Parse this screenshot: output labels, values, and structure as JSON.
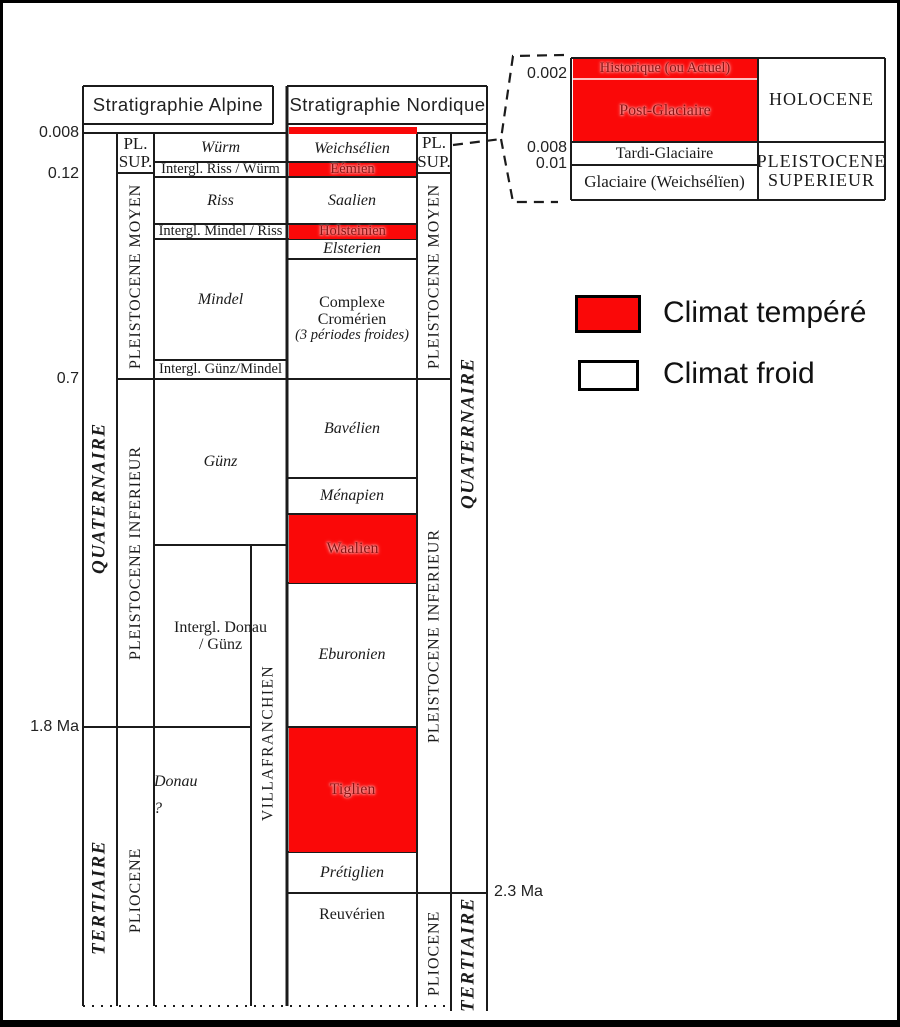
{
  "colors": {
    "red": "#fa0808",
    "red_text": "#8c1212",
    "line": "#1b1b1b"
  },
  "headers": {
    "alpine": "Stratigraphie  Alpine",
    "nordic": "Stratigraphie  Nordique"
  },
  "axis": {
    "a008": "0.008",
    "a012": "0.12",
    "a07": "0.7",
    "a18": "1.8 Ma",
    "a23": "2.3 Ma"
  },
  "left": {
    "quaternaire": "QUATERNAIRE",
    "tertiaire": "TERTIAIRE",
    "pl": "PL.",
    "sup": "SUP.",
    "moyen": "PLEISTOCENE MOYEN",
    "inferieur": "PLEISTOCENE INFERIEUR",
    "pliocene": "PLIOCENE"
  },
  "right": {
    "quaternaire": "QUATERNAIRE",
    "tertiaire": "TERTIAIRE",
    "pl": "PL.",
    "sup": "SUP.",
    "moyen": "PLEISTOCENE MOYEN",
    "inferieur": "PLEISTOCENE INFERIEUR",
    "pliocene": "PLIOCENE"
  },
  "alpine": {
    "wurm": "Würm",
    "riss_wurm": "Intergl. Riss / Würm",
    "riss": "Riss",
    "mindel_riss": "Intergl. Mindel / Riss",
    "mindel": "Mindel",
    "gunz_mindel": "Intergl. Günz/Mindel",
    "gunz": "Günz",
    "donau_gunz_l1": "Intergl. Donau",
    "donau_gunz_l2": "/ Günz",
    "donau": "Donau",
    "donau_q": "?",
    "villafranchien": "VILLAFRANCHIEN"
  },
  "nordic": {
    "weichselien": "Weichsélien",
    "eemien": "Eémien",
    "saalien": "Saalien",
    "holsteinien": "Holsteinien",
    "elsterien": "Elsterien",
    "cromerien_l1": "Complexe",
    "cromerien_l2": "Cromérien",
    "cromerien_l3": "(3 périodes froides)",
    "bavelien": "Bavélien",
    "menapien": "Ménapien",
    "waalien": "Waalien",
    "eburonien": "Eburonien",
    "tiglien": "Tiglien",
    "pretiglien": "Prétiglien",
    "reuverien": "Reuvérien"
  },
  "inset": {
    "historique": "Historique (ou Actuel)",
    "post_glaciaire": "Post-Glaciaire",
    "holocene": "HOLOCENE",
    "tardi": "Tardi-Glaciaire",
    "glaciaire": "Glaciaire (Weichsélïen)",
    "pleistocene_l1": "PLEISTOCENE",
    "pleistocene_l2": "SUPERIEUR",
    "a0002": "0.002",
    "a0008": "0.008",
    "a001": "0.01"
  },
  "legend": {
    "tempere": "Climat tempéré",
    "froid": "Climat froid"
  }
}
